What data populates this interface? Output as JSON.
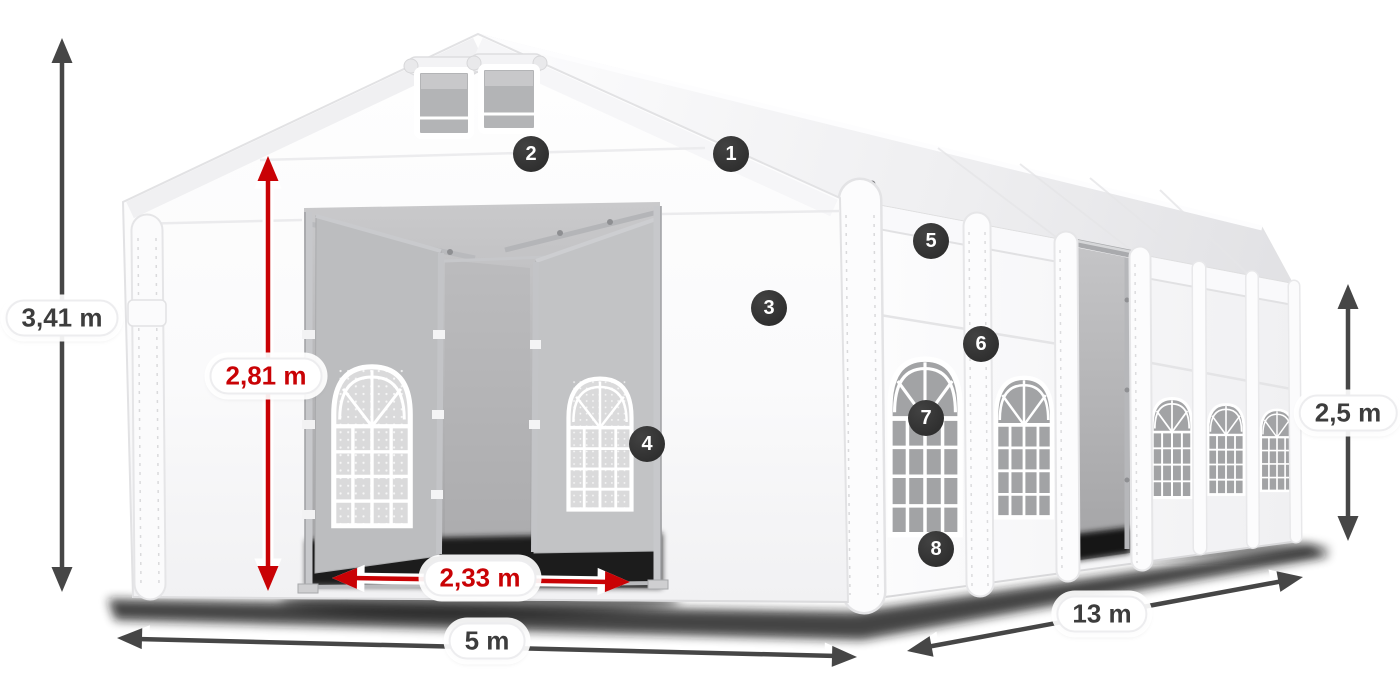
{
  "dimension_labels": [
    {
      "id": "total-height",
      "text": "3,41 m",
      "color": "gray"
    },
    {
      "id": "entrance-height",
      "text": "2,81 m",
      "color": "red"
    },
    {
      "id": "entrance-width",
      "text": "2,33 m",
      "color": "red"
    },
    {
      "id": "tent-width",
      "text": "5 m",
      "color": "gray"
    },
    {
      "id": "tent-length",
      "text": "13 m",
      "color": "gray"
    },
    {
      "id": "side-height",
      "text": "2,5 m",
      "color": "gray"
    }
  ],
  "feature_markers": [
    {
      "number": "1"
    },
    {
      "number": "2"
    },
    {
      "number": "3"
    },
    {
      "number": "4"
    },
    {
      "number": "5"
    },
    {
      "number": "6"
    },
    {
      "number": "7"
    },
    {
      "number": "8"
    }
  ],
  "colors": {
    "dimension_gray": "#464646",
    "dimension_red": "#c90205",
    "marker_background": "#2e2e2e",
    "marker_text": "#ffffff",
    "label_background": "#ffffff",
    "tent_fabric": "#ffffff",
    "window_glass": "#a2a3a5"
  }
}
